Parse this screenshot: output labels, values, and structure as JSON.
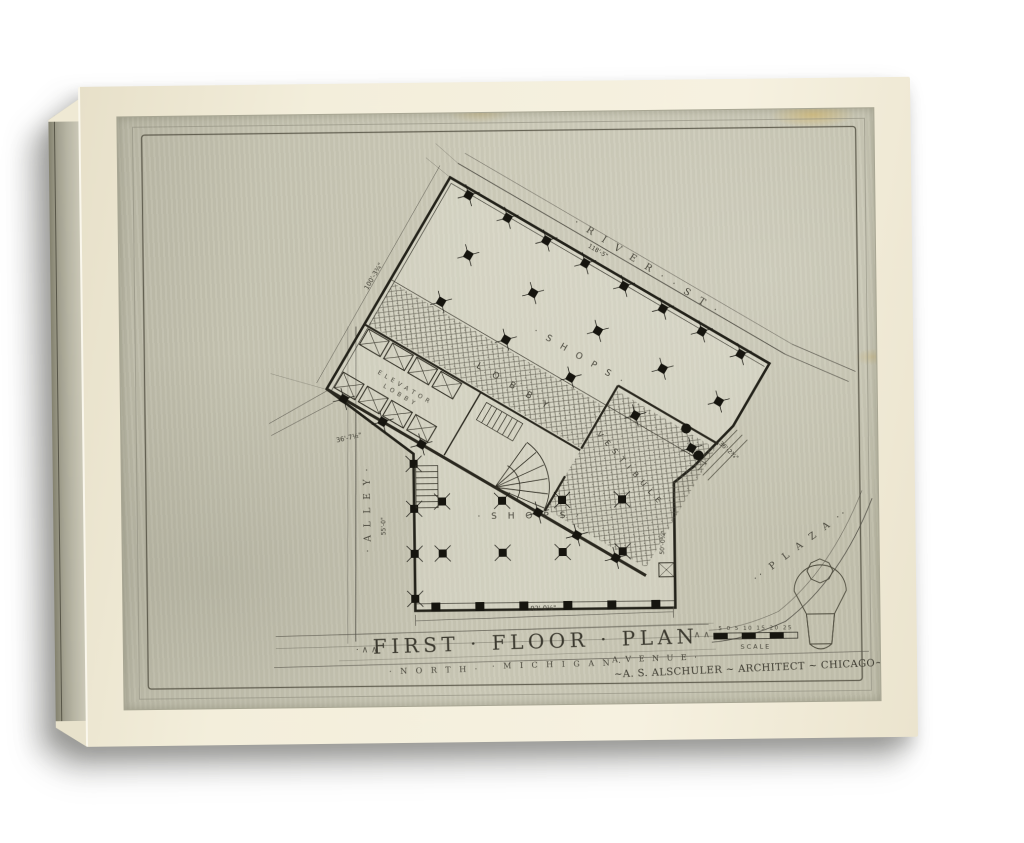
{
  "artwork": {
    "title_prefix": "· ∧ ∧",
    "title": "FIRST · FLOOR · PLAN",
    "title_suffix": "∧ ∧ ·",
    "credit": "~A. S. ALSCHULER ~ ARCHITECT ~ CHICAGO~",
    "streets": {
      "river_st": "· R I V E R ·  · S T ·",
      "alley": "· A L L E Y ·",
      "north": "· N O R T H ·",
      "michigan": "· M I C H I G A N ·",
      "avenue": "· A V E N U E ·",
      "plaza": "·· P L A Z A ··"
    },
    "rooms": {
      "shops_upper": "· S H O P S ·",
      "lobby": "L O B B Y",
      "vestibule": "V E S T I B U L E",
      "elevator_line1": "E L E V A T O R",
      "elevator_line2": "L O B B Y",
      "shops_lower": "· S H O P S ·"
    },
    "dimensions": {
      "west_wall": "100'-3¾\"",
      "river_wall": "118'-5\"",
      "bend_wall": "36'-7½\"",
      "alley_side": "55'-0\"",
      "michigan_front": "92'-0½\"",
      "plaza_entrance": "36'-2¾\"",
      "east_side": "50'-0¾\""
    },
    "scale_bar": {
      "numbers": "5 0 5 10 15 20 25",
      "label": "SCALE"
    }
  }
}
